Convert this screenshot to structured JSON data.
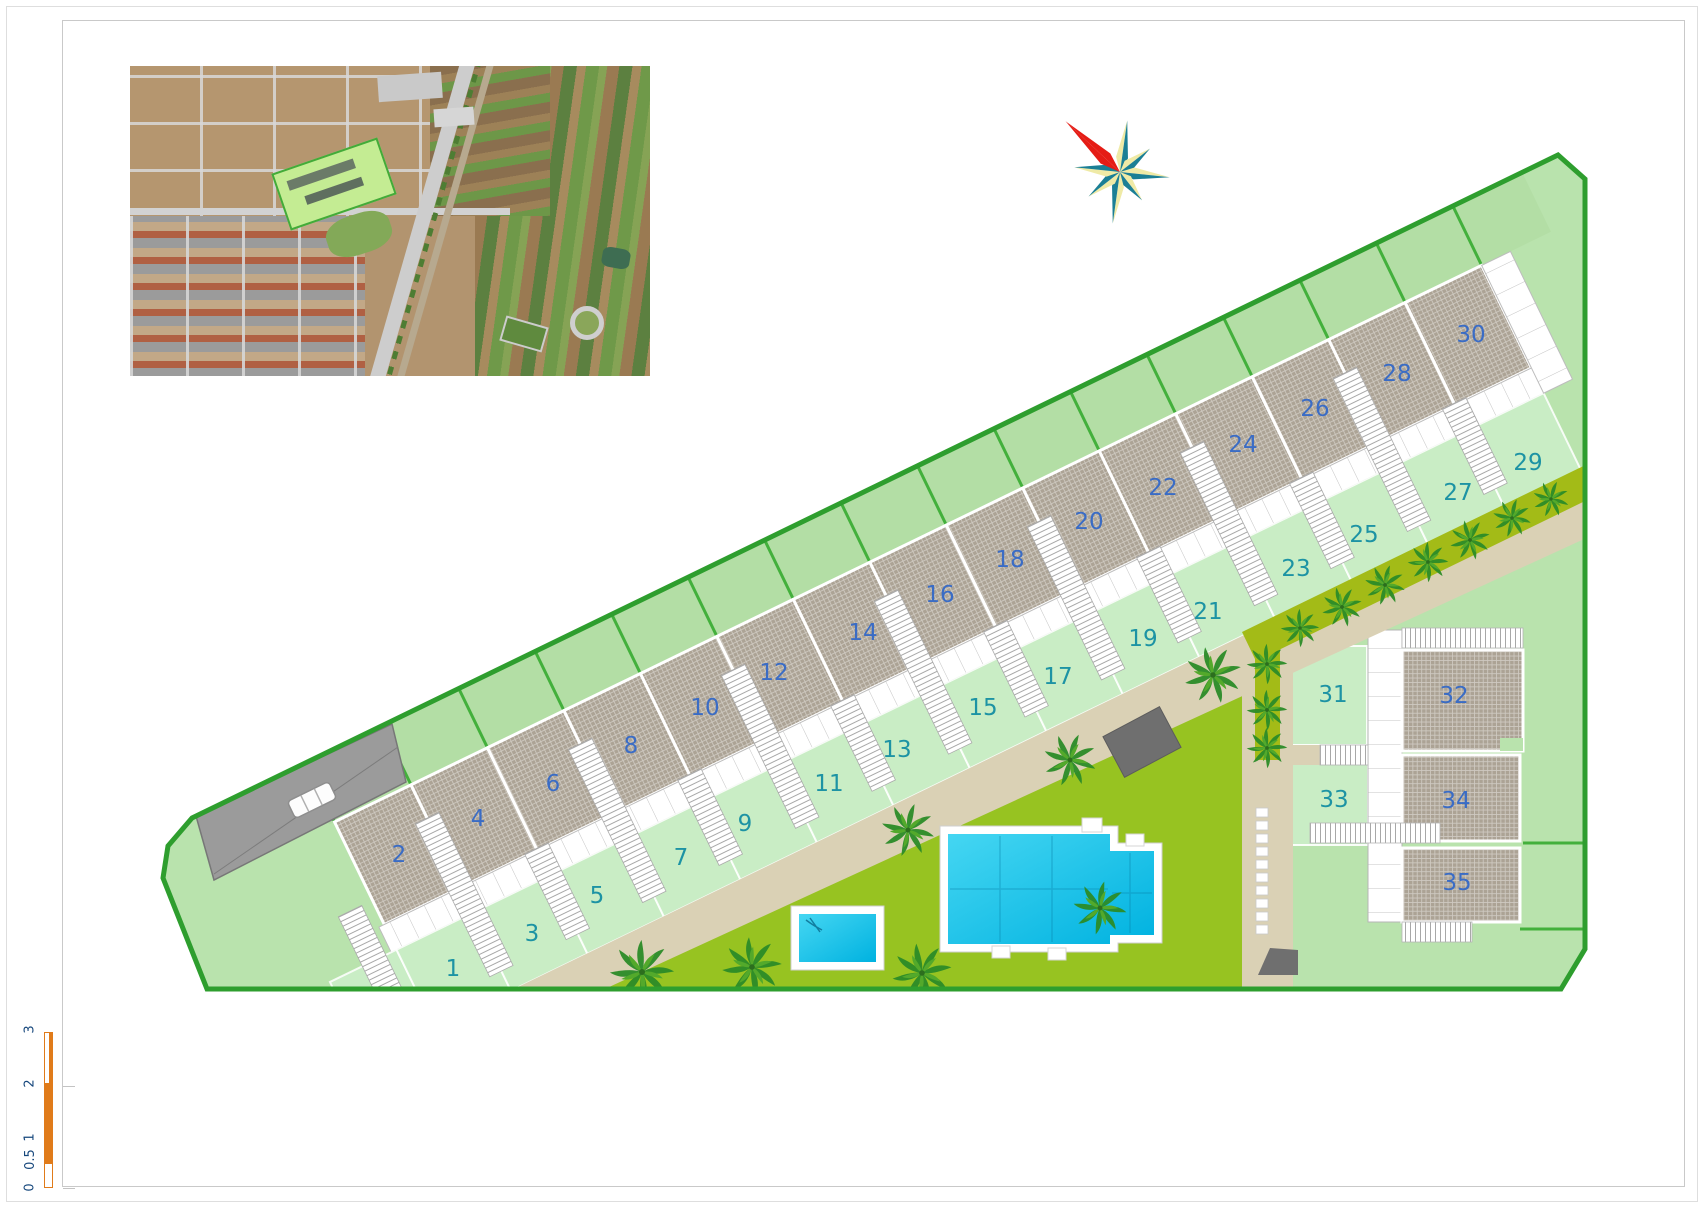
{
  "document": {
    "type": "residential development site plan",
    "page_background": "#ffffff"
  },
  "plot_numbers": [
    "1",
    "2",
    "3",
    "4",
    "5",
    "6",
    "7",
    "8",
    "9",
    "10",
    "11",
    "12",
    "13",
    "14",
    "15",
    "16",
    "17",
    "18",
    "19",
    "20",
    "21",
    "22",
    "23",
    "24",
    "25",
    "26",
    "27",
    "28",
    "29",
    "30",
    "31",
    "32",
    "33",
    "34",
    "35"
  ],
  "scale_bar": {
    "labels": [
      "0",
      "0.5",
      "1",
      "2",
      "3"
    ],
    "bar_color": "#e07b1a"
  },
  "icons": {
    "compass": "compass-rose-icon"
  },
  "colors": {
    "boundary_green": "#2e9e2e",
    "divider_green": "#43b03c",
    "site_green": "#b9e3ad",
    "front_garden_green": "#c9edc5",
    "back_garden_green": "#b3dea5",
    "lawn_green": "#97c321",
    "roof_gray": "#aca395",
    "path_beige": "#dad1b5",
    "pool_cyan": "#2cc9ef",
    "roof_number_blue": "#3a6cc5",
    "garden_number_teal": "#1d93a4",
    "compass_red": "#e51c15",
    "compass_teal": "#1b7f95",
    "compass_yellow": "#efeaa6"
  }
}
